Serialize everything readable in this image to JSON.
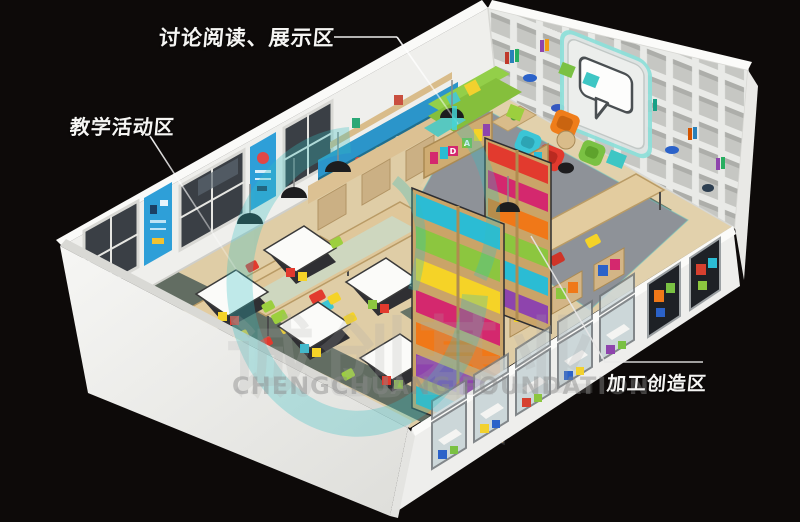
{
  "labels": {
    "discussion": "讨论阅读、展示区",
    "teaching": "教学活动区",
    "making": "加工创造区"
  },
  "watermark": {
    "cjk": "诚创基业",
    "latin": "CHENGCHUANG FOUNDATION"
  },
  "decor": {
    "shelf_letter_1": "D",
    "shelf_letter_2": "A",
    "sign_letter": "M"
  },
  "colors": {
    "background": "#0d0a09",
    "wall_white": "#f1f1ef",
    "floor_wood": "#dfcda6",
    "path_green": "#57655c",
    "carpet_gray": "#8e9298",
    "accent_teal": "#34bfc2",
    "sofa_green": "#8cc63f",
    "armchair_orange": "#ef7d1a",
    "armchair_red": "#e23a2e",
    "armchair_cyan": "#3bc5d6",
    "armchair_lime": "#7ac143",
    "shelf_wood": "#cfa96e",
    "glass_blue": "#c7d3d6",
    "poster_blue": "#2e9fd8",
    "label_white": "#f5f5f3"
  }
}
